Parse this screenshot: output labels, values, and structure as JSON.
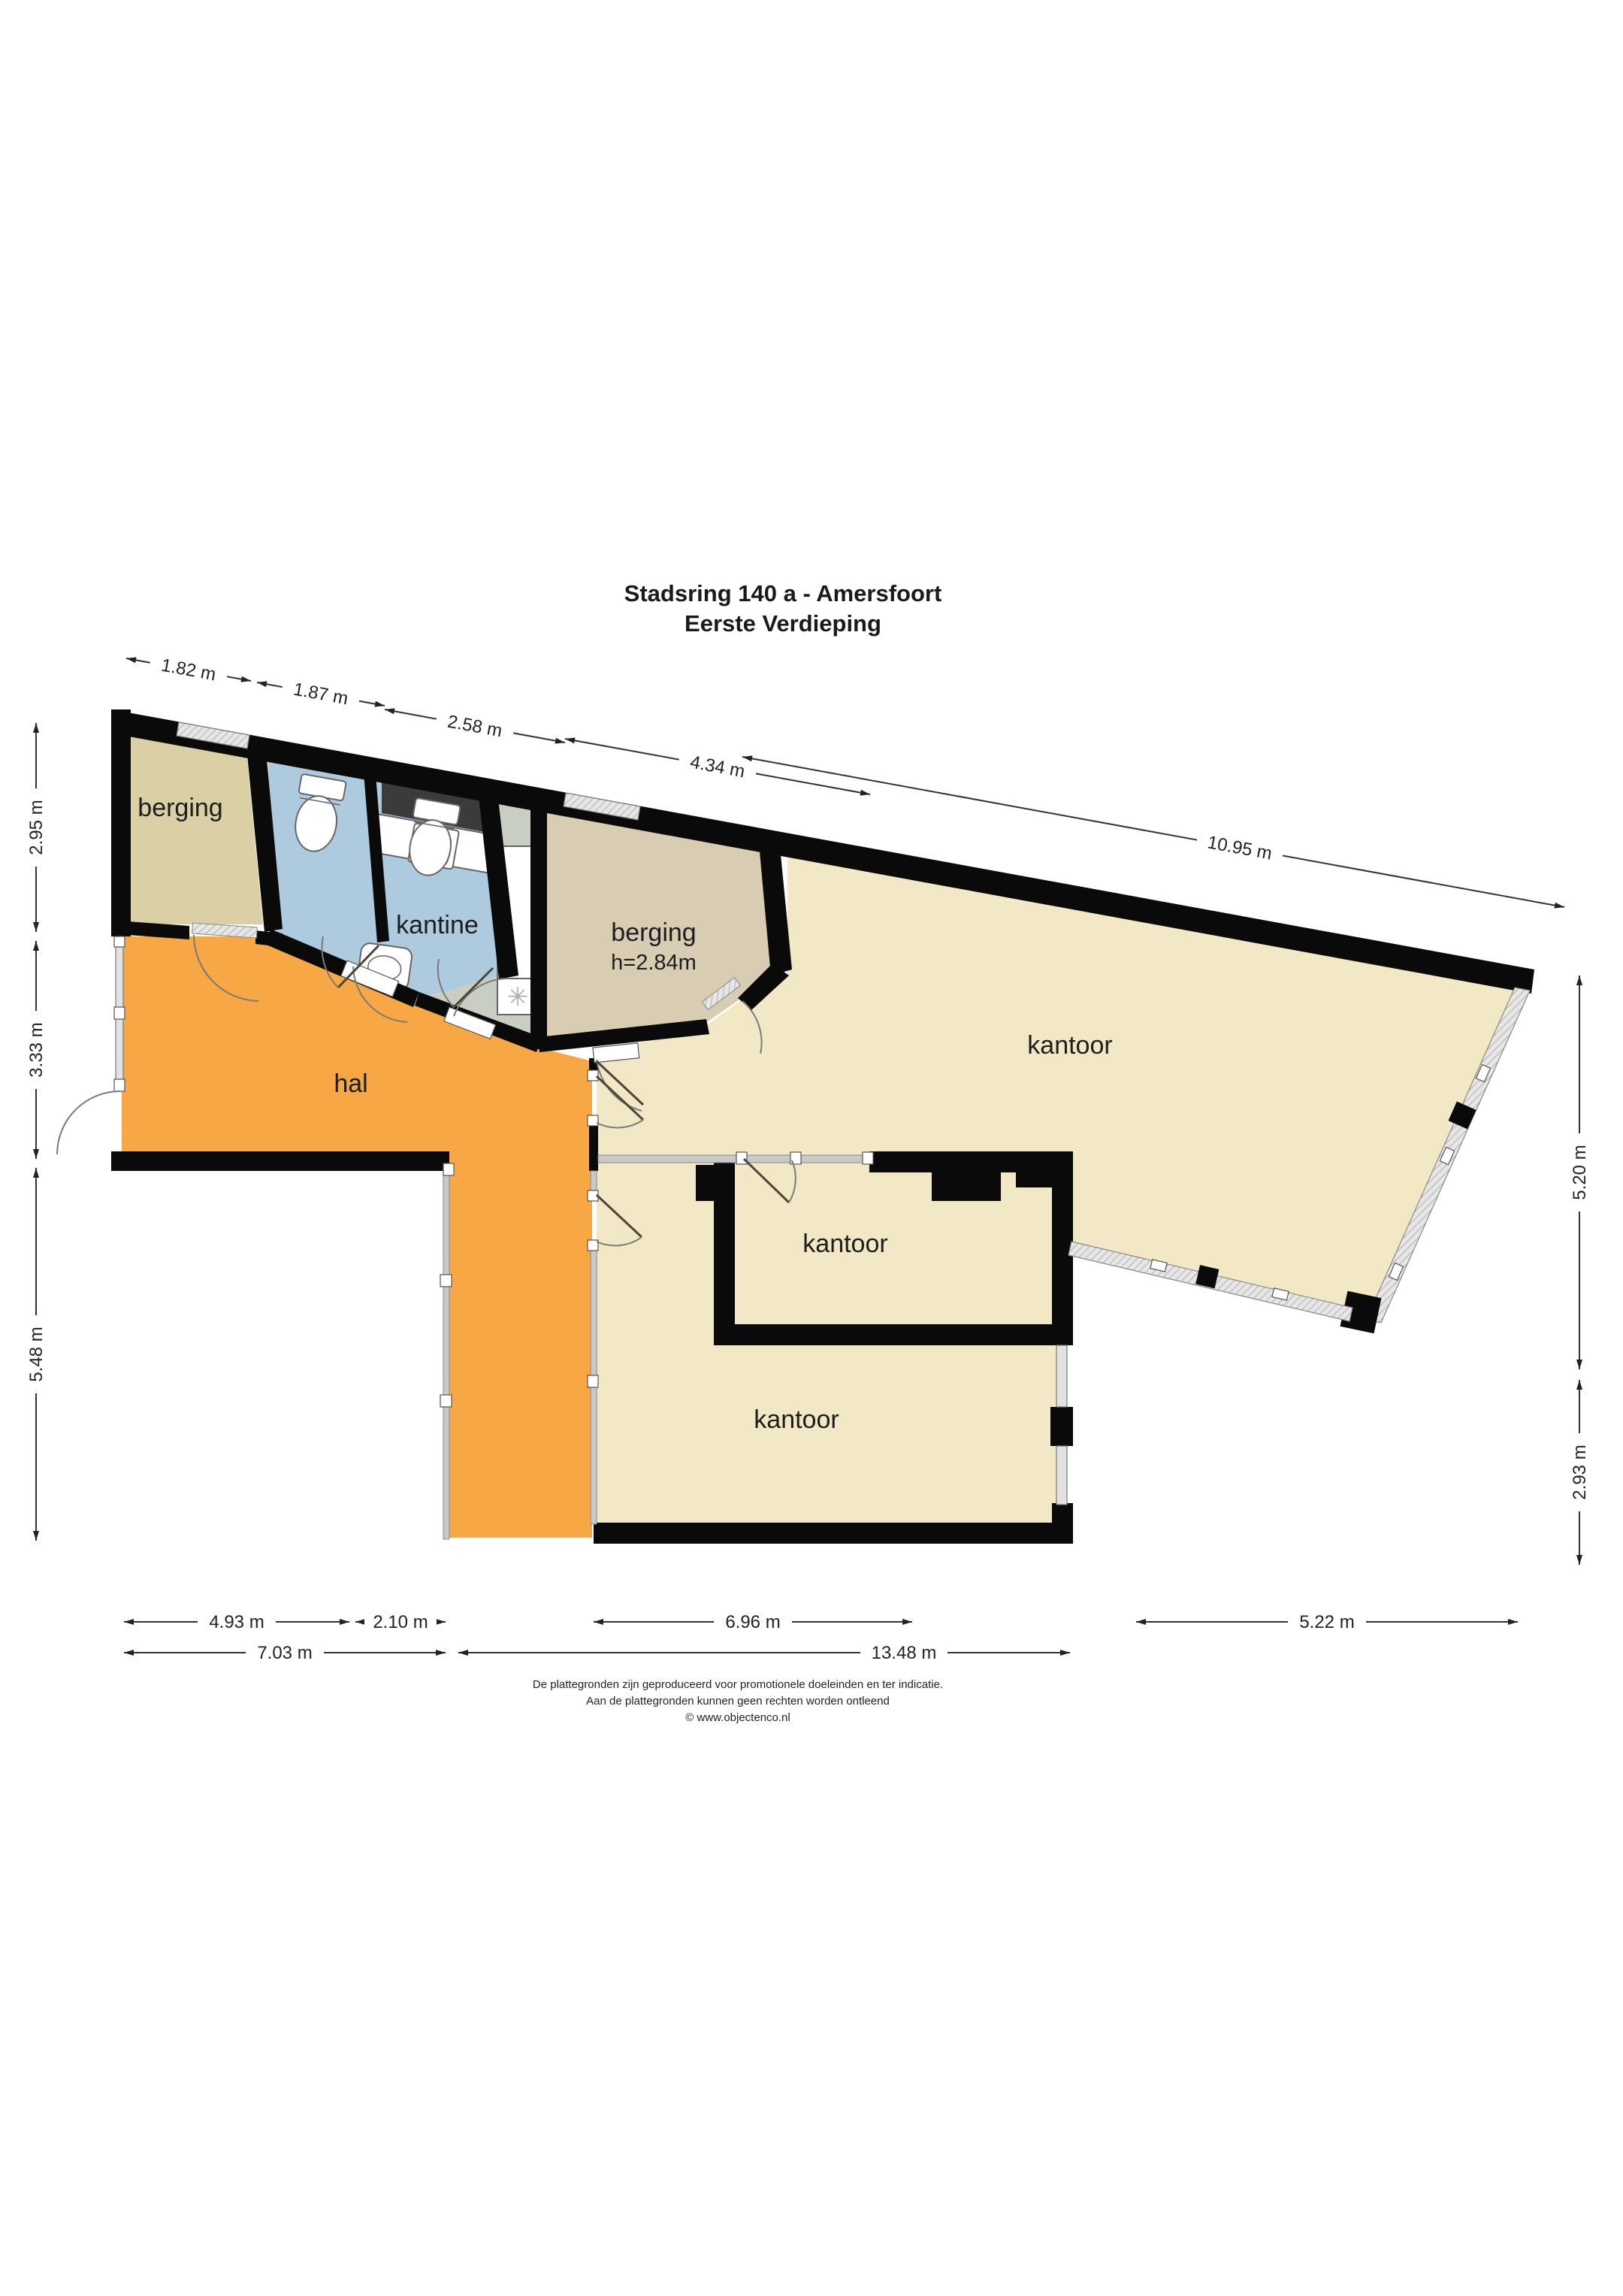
{
  "title": {
    "line1": "Stadsring 140 a - Amersfoort",
    "line2": "Eerste Verdieping"
  },
  "rooms": {
    "berging1": "berging",
    "kantine": "kantine",
    "berging2": "berging",
    "berging2_height": "h=2.84m",
    "kantoor_large": "kantoor",
    "kantoor_mid": "kantoor",
    "kantoor_bottom": "kantoor",
    "hal": "hal"
  },
  "dimensions": {
    "top": [
      "1.82 m",
      "1.87 m",
      "2.58 m",
      "4.34 m",
      "10.95 m"
    ],
    "left": [
      "2.95 m",
      "3.33 m",
      "5.48 m"
    ],
    "right": [
      "5.20 m",
      "2.93 m"
    ],
    "bottom_row1": [
      "4.93 m",
      "2.10 m",
      "6.96 m",
      "5.22 m"
    ],
    "bottom_row2": [
      "7.03 m",
      "13.48 m"
    ]
  },
  "footer": {
    "line1": "De plattegronden zijn geproduceerd voor promotionele doeleinden en ter indicatie.",
    "line2": "Aan de plattegronden kunnen geen rechten worden ontleend",
    "line3": "© www.objectenco.nl"
  },
  "colors": {
    "hal": "#F7A845",
    "kantoor": "#F3E8C5",
    "berging1": "#DBCFA6",
    "berging2": "#D8CDB2",
    "kantine": "#C8CFC2",
    "toilets": "#AECADF",
    "wall": "#0A0A0A",
    "counter_dark": "#3B3B3B",
    "glass": "#C9C9C9",
    "dim_line": "#333333"
  },
  "icons": {
    "freezer_glyph": "✳"
  }
}
